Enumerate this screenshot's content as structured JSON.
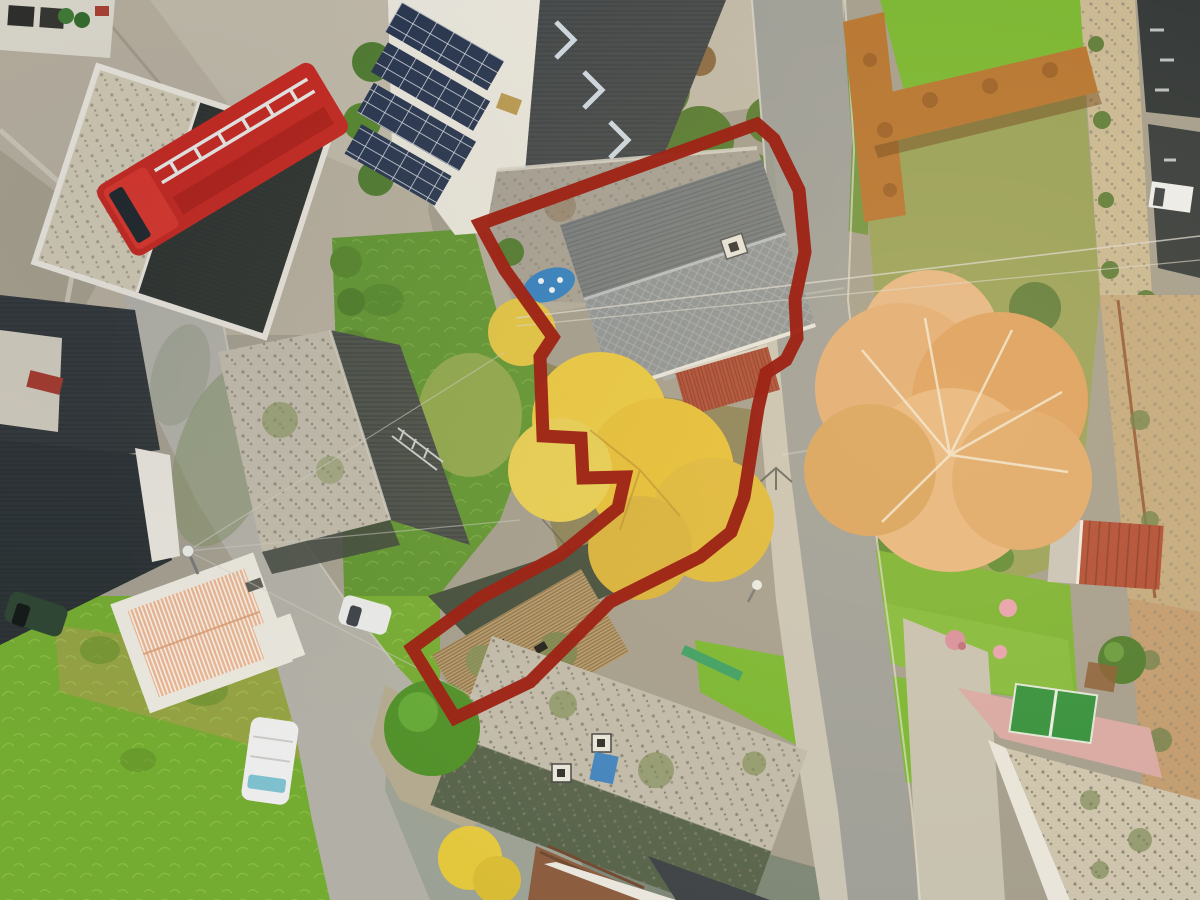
{
  "meta": {
    "title": "Aerial drone photo of village property with red boundary outline",
    "view": "top-down oblique drone shot, autumn"
  },
  "annotation": {
    "name": "property-boundary",
    "color": "#9e2517",
    "stroke_width": 13,
    "points": "480,224 757,124 774,139 799,190 805,252 795,299 797,338 786,360 766,373 758,408 744,497 731,532 700,557 610,602 530,682 455,718 412,648 480,598 560,555 618,508 625,477 583,478 581,438 543,436 540,357 553,337 505,270"
  },
  "palette": {
    "boundary_red": "#9e2517",
    "asphalt": "#9d9e99",
    "sidewalk": "#c9c4b6",
    "street_concrete": "#b1afa6",
    "concrete_court": "#b6ae9d",
    "lawn_bright": "#77b62f",
    "lawn_mid": "#5f9530",
    "meadow_green": "#74ab31",
    "meadow_olive": "#97a144",
    "slate_dark": "#33383a",
    "slate_navy": "#2d3335",
    "roof_mossy_light": "#c0baab",
    "roof_moss_dark": "#55624a",
    "house_slate": "#8f9394",
    "house_slate_dark": "#777c7e",
    "stone_barn": "#a6a094",
    "roof_white": "#eae7dd",
    "solar_panel": "#26344e",
    "red_roof": "#b04a33",
    "tile_roof_salmon": "#e8b391",
    "hedge_orange": "#b5732f",
    "autumn_tree": "#e2ad74",
    "yellow_tree": "#eac83e",
    "fire_truck_red": "#c5271f",
    "pool_blue": "#2f7fc2",
    "patio_pink": "#d8a8a4",
    "stone_wall": "#c2a87e",
    "trampoline_green": "#2f8f3a"
  },
  "scene_objects": [
    {
      "id": "property-boundary",
      "label": "red property boundary outline"
    },
    {
      "id": "main-road",
      "label": "asphalt road running top-right to bottom"
    },
    {
      "id": "side-street",
      "label": "village side street, left"
    },
    {
      "id": "fire-truck",
      "label": "red fire engine parked top-left"
    },
    {
      "id": "solar-roof-building",
      "label": "building with blue solar panels"
    },
    {
      "id": "main-house",
      "label": "slate-roof house inside boundary"
    },
    {
      "id": "stone-barn",
      "label": "stone barn roof inside boundary"
    },
    {
      "id": "old-barn",
      "label": "weathered barn roofs at bottom of boundary"
    },
    {
      "id": "autumn-tree",
      "label": "large orange autumn tree"
    },
    {
      "id": "yellow-tree",
      "label": "golden tree in garden"
    },
    {
      "id": "orange-hedge",
      "label": "rust-colored beech hedges"
    },
    {
      "id": "red-shed",
      "label": "small shed with red corrugated roof"
    },
    {
      "id": "tile-roof-house",
      "label": "house with salmon tile roof, left"
    },
    {
      "id": "white-van",
      "label": "white van parked on side street"
    },
    {
      "id": "pool",
      "label": "small blue pool on terrace"
    }
  ]
}
